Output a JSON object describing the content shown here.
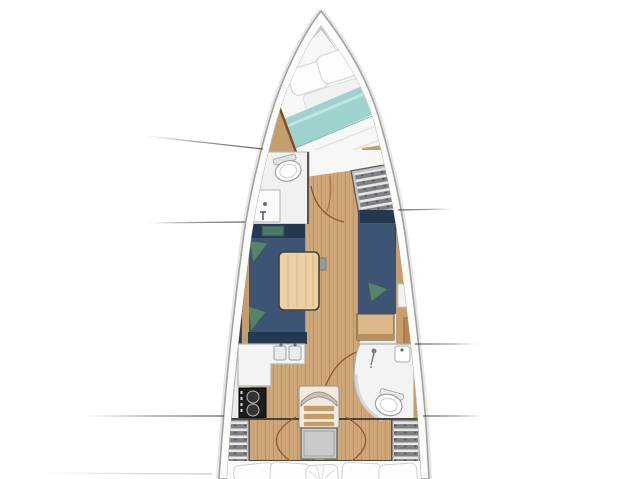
{
  "figure": {
    "type": "sailboat-interior-floor-plan",
    "orientation": "bow-up",
    "visible_text": [],
    "regions": [
      {
        "id": "anchor-locker",
        "name": "bow anchor locker"
      },
      {
        "id": "v-berth",
        "name": "forward cabin double berth with teal blanket and pillows"
      },
      {
        "id": "forward-head",
        "name": "forward bathroom with toilet and sink"
      },
      {
        "id": "forward-wardrobe",
        "name": "starboard forward shelved wardrobe"
      },
      {
        "id": "port-settee",
        "name": "port salon settee with green cushions"
      },
      {
        "id": "starboard-settee",
        "name": "starboard salon settee with green cushion"
      },
      {
        "id": "salon-table",
        "name": "wooden salon table"
      },
      {
        "id": "nav-station",
        "name": "starboard nav desk"
      },
      {
        "id": "galley",
        "name": "port galley with double sink and stove"
      },
      {
        "id": "companionway-stairs",
        "name": "central companionway steps"
      },
      {
        "id": "engine-box",
        "name": "engine compartment box"
      },
      {
        "id": "aft-head",
        "name": "aft bathroom with shower, sink and toilet"
      },
      {
        "id": "port-aft-wardrobe",
        "name": "port aft shelved wardrobe"
      },
      {
        "id": "starboard-aft-wardrobe",
        "name": "starboard aft shelved wardrobe"
      },
      {
        "id": "aft-berth",
        "name": "aft cabin berth with pillows"
      }
    ]
  },
  "colors": {
    "page_bg": "#ffffff",
    "hull_outline": "#a2a2a0",
    "hull_halo": "#e6e6e4",
    "deck_white": "#fcfcfb",
    "interior_base": "#ececea",
    "anchor_gray": "#c6c6c4",
    "anchor_dark": "#9b9b99",
    "mattress": "#f7f7f5",
    "pillow": "#fdfdfc",
    "pillow_stroke": "#d0d0ce",
    "blanket_teal": "#9ed2cf",
    "wood_floor": "#cfa778",
    "wood_trim": "#c59e6e",
    "wood_edge": "#7e4f28",
    "table_wood": "#ecd0a5",
    "settee_navy": "#3e5474",
    "settee_navy_dark": "#243850",
    "cushion_green": "#57836c",
    "head_floor": "#f0f1f1",
    "fixture_stroke": "#9fa5a5",
    "wall": "#46463f",
    "stove_black": "#1c1c1c",
    "stairs_frame": "#f0ebe2",
    "step_wood": "#c79d67",
    "engine_gray": "#c9cbca",
    "engine_stroke": "#707270",
    "callout_line": "#3c3c3a"
  },
  "callouts": [
    {
      "x1": 146,
      "y1": 136,
      "x2": 263,
      "y2": 149,
      "fade": "left",
      "opacity": 0.9
    },
    {
      "x1": 147,
      "y1": 223,
      "x2": 245,
      "y2": 222,
      "fade": "left",
      "opacity": 0.9
    },
    {
      "x1": 88,
      "y1": 416,
      "x2": 224,
      "y2": 416,
      "fade": "left",
      "opacity": 0.9
    },
    {
      "x1": 46,
      "y1": 473,
      "x2": 212,
      "y2": 474,
      "fade": "left",
      "opacity": 0.3
    },
    {
      "x1": 398,
      "y1": 210,
      "x2": 452,
      "y2": 209,
      "fade": "right",
      "opacity": 0.9
    },
    {
      "x1": 415,
      "y1": 344,
      "x2": 477,
      "y2": 344,
      "fade": "right",
      "opacity": 0.9
    },
    {
      "x1": 423,
      "y1": 416,
      "x2": 483,
      "y2": 416,
      "fade": "right",
      "opacity": 0.9
    }
  ]
}
